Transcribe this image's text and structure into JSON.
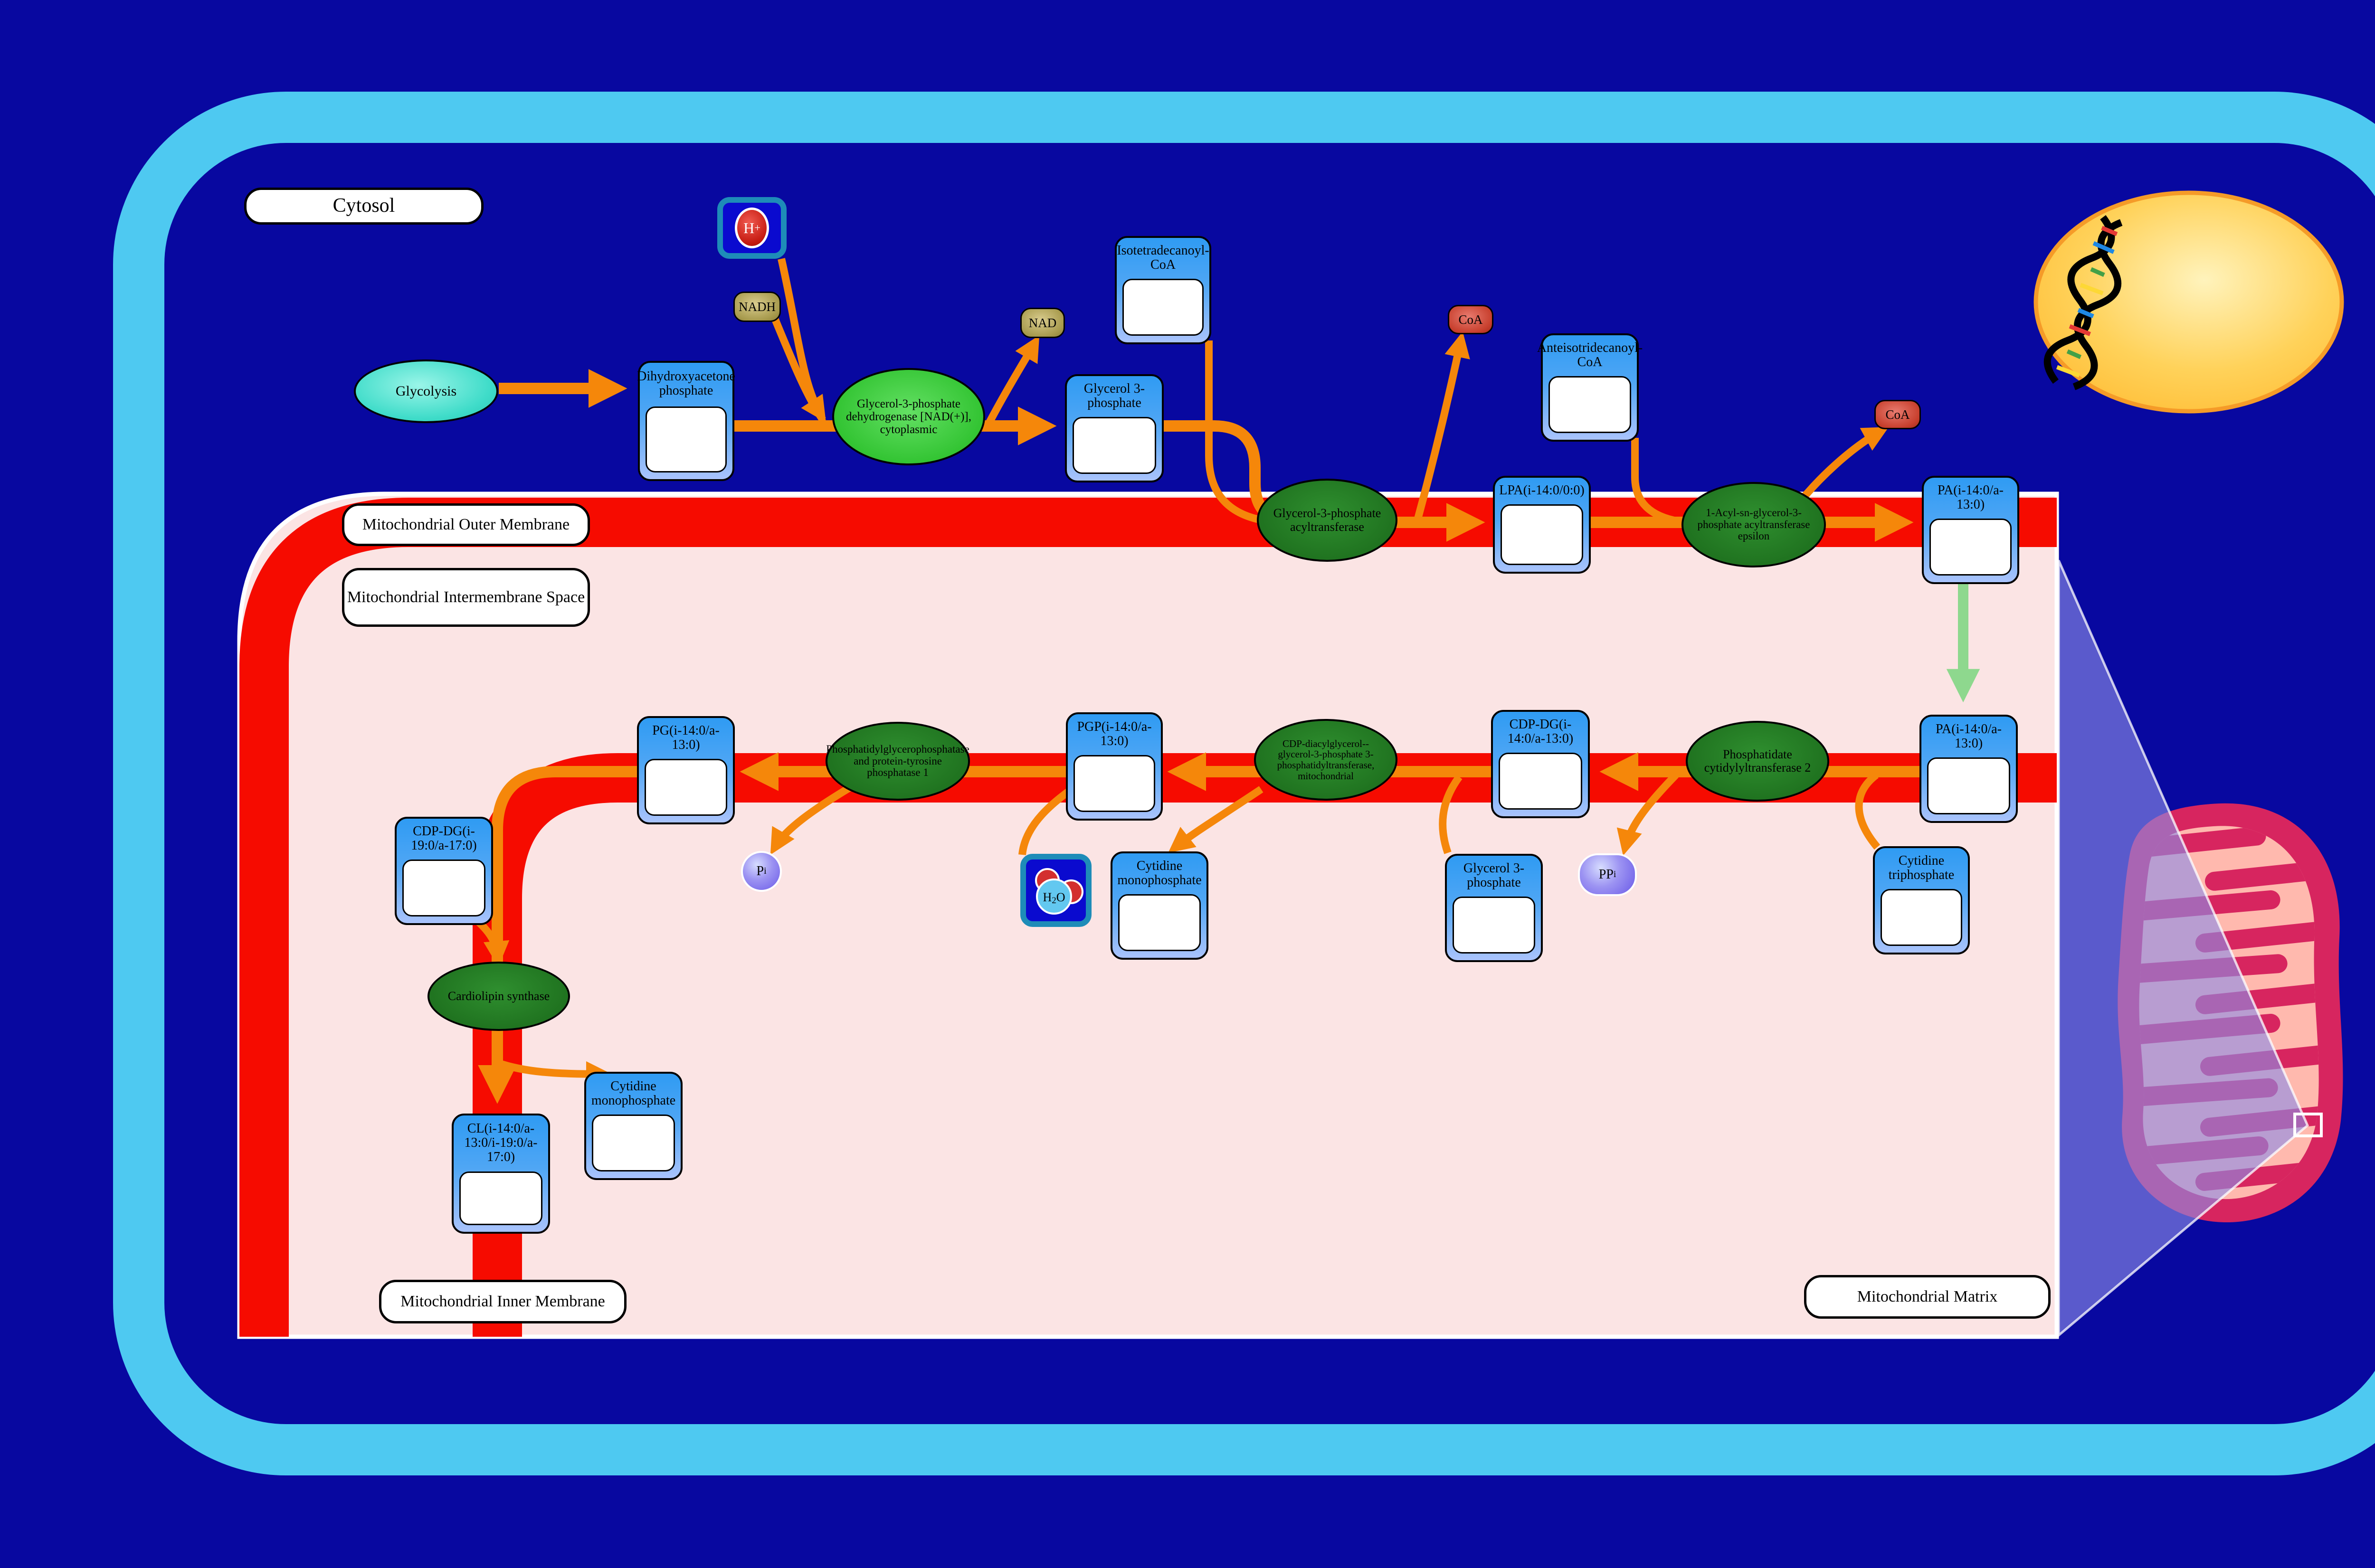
{
  "labels": {
    "cytosol": "Cytosol",
    "outer_membrane": "Mitochondrial Outer Membrane",
    "intermembrane_space": "Mitochondrial Intermembrane Space",
    "inner_membrane": "Mitochondrial Inner Membrane",
    "matrix": "Mitochondrial Matrix"
  },
  "process": {
    "glycolysis": "Glycolysis"
  },
  "metabolites": {
    "dhap": "Dihydroxyacetone phosphate",
    "g3p_cytosol": "Glycerol 3-phosphate",
    "isotetradecanoyl_coa": "Isotetradecanoyl-CoA",
    "anteisotridecanoyl_coa": "Anteisotridecanoyl-CoA",
    "lpa": "LPA(i-14:0/0:0)",
    "pa_outer": "PA(i-14:0/a-13:0)",
    "pa_inner": "PA(i-14:0/a-13:0)",
    "cdp_dg_14": "CDP-DG(i-14:0/a-13:0)",
    "pgp": "PGP(i-14:0/a-13:0)",
    "pg": "PG(i-14:0/a-13:0)",
    "cdp_dg_19": "CDP-DG(i-19:0/a-17:0)",
    "cl": "CL(i-14:0/a-13:0/i-19:0/a-17:0)",
    "cmp_inner": "Cytidine monophosphate",
    "cmp_matrix": "Cytidine monophosphate",
    "ctp": "Cytidine triphosphate",
    "g3p_matrix": "Glycerol 3-phosphate"
  },
  "enzymes": {
    "gpd1": "Glycerol-3-phosphate dehydrogenase [NAD(+)], cytoplasmic",
    "gpat": "Glycerol-3-phosphate acyltransferase",
    "agpat_epsilon": "1-Acyl-sn-glycerol-3-phosphate acyltransferase epsilon",
    "pct2": "Phosphatidate cytidylyltransferase 2",
    "cdp_dg_synthase": "CDP-diacylglycerol--glycerol-3-phosphate 3-phosphatidyltransferase, mitochondrial",
    "pgp_phosphatase": "Phosphatidylglycerophosphatase and protein-tyrosine phosphatase 1",
    "cls": "Cardiolipin synthase"
  },
  "small_molecules": {
    "nadh": "NADH",
    "nad": "NAD",
    "coa_outer_1": "CoA",
    "coa_outer_2": "CoA",
    "h_plus": {
      "base": "H",
      "sup": "+"
    },
    "h2o": {
      "h": "H",
      "sub": "2",
      "o": "O"
    },
    "pi": {
      "base": "P",
      "sub": "i"
    },
    "ppi": {
      "base": "PP",
      "sub": "i"
    }
  },
  "colors": {
    "background": "#0808A0",
    "cell_border": "#4EC9F1",
    "membrane_red": "#F60B00",
    "compartment_pink": "#FBE4E4",
    "arrow_orange": "#F5870A",
    "arrow_green": "#8ED88E",
    "enzyme_green_dark": "#1E701E",
    "enzyme_green_bright": "#33C433",
    "metabolite_header_blue": "#2F9BF3",
    "metabolite_body_blue": "#A9C3FC",
    "glycolysis_cyan": "#3FDCC9",
    "nad_olive": "#A89B4E",
    "coa_red": "#C8402E",
    "phosphate_purple": "#6A5AE8",
    "nucleus_yellow": "#FFC94B",
    "mitochondrion_outer": "#D7255F",
    "mitochondrion_inner": "#FFB9AE",
    "lens_overlay": "#8C8CE6"
  },
  "icons": {
    "dna": "dna-double-helix-icon",
    "water": "water-molecule-icon",
    "proton": "proton-icon",
    "structure": "molecule-structure-icon",
    "zoom_region": "zoom-region-indicator"
  }
}
